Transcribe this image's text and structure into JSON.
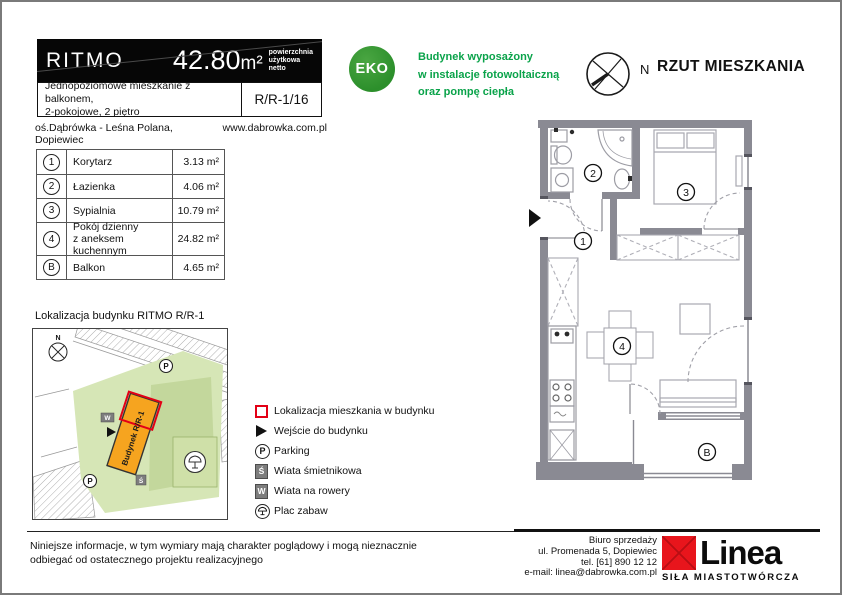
{
  "header": {
    "project_name": "RITMO",
    "area_value": "42.80",
    "area_unit": "m²",
    "area_label_l1": "powierzchnia",
    "area_label_l2": "użytkowa",
    "area_label_l3": "netto",
    "description_line1": "Jednopoziomowe mieszkanie z balkonem,",
    "description_line2": "2-pokojowe, 2 piętro",
    "unit_code": "R/R-1/16",
    "address": "oś.Dąbrówka - Leśna Polana, Dopiewiec",
    "website": "www.dabrowka.com.pl"
  },
  "eco": {
    "badge": "EKO",
    "badge_color": "#2c8f2b",
    "text_color": "#0aa34a",
    "line1": "Budynek wyposażony",
    "line2": "w instalacje fotowoltaiczną",
    "line3": "oraz pompę ciepła"
  },
  "plan": {
    "title": "RZUT MIESZKANIA",
    "compass_label": "N",
    "labels": {
      "n1": "1",
      "n2": "2",
      "n3": "3",
      "n4": "4",
      "nb": "B"
    }
  },
  "rooms_table": {
    "rows": [
      {
        "id": "1",
        "name": "Korytarz",
        "name2": "",
        "area": "3.13 m²"
      },
      {
        "id": "2",
        "name": "Łazienka",
        "name2": "",
        "area": "4.06 m²"
      },
      {
        "id": "3",
        "name": "Sypialnia",
        "name2": "",
        "area": "10.79 m²"
      },
      {
        "id": "4",
        "name": "Pokój dzienny",
        "name2": "z aneksem kuchennym",
        "area": "24.82 m²"
      },
      {
        "id": "B",
        "name": "Balkon",
        "name2": "",
        "area": "4.65 m²"
      }
    ]
  },
  "location": {
    "title": "Lokalizacja budynku RITMO R/R-1",
    "building_label": "Budynek R/R-1",
    "compass_label": "N",
    "parking_label": "P",
    "shed_label": "Ś",
    "bike_label": "W",
    "building_color": "#f6a41f",
    "highlight_color": "#e30016"
  },
  "legend": {
    "items": [
      {
        "icon": "red-square",
        "label": "Lokalizacja mieszkania w budynku"
      },
      {
        "icon": "entrance-arrow",
        "label": "Wejście do budynku"
      },
      {
        "icon": "parking",
        "label": "Parking"
      },
      {
        "icon": "shed",
        "label": "Wiata śmietnikowa"
      },
      {
        "icon": "bike-shed",
        "label": "Wiata na rowery"
      },
      {
        "icon": "playground",
        "label": "Plac zabaw"
      }
    ]
  },
  "footer": {
    "disclaimer_line1": "Niniejsze informacje, w tym wymiary mają charakter poglądowy i mogą nieznacznie",
    "disclaimer_line2": "odbiegać od ostatecznego projektu realizacyjnego",
    "office_line1": "Biuro sprzedaży",
    "office_line2": "ul. Promenada 5, Dopiewiec",
    "office_line3": "tel. [61] 890 12 12",
    "office_line4": "e-mail: linea@dabrowka.com.pl",
    "logo_text": "Linea",
    "logo_tagline": "SIŁA MIASTOTWÓRCZA"
  }
}
